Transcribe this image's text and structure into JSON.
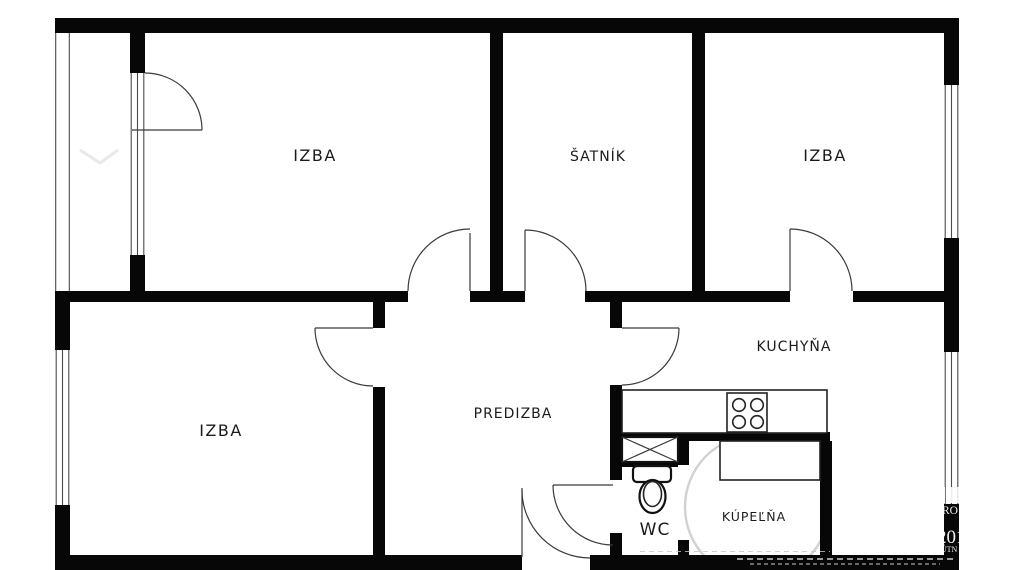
{
  "floorplan": {
    "rooms": [
      {
        "id": "izba-top-left",
        "label": "IZBA"
      },
      {
        "id": "satnik",
        "label": "ŠATNÍK"
      },
      {
        "id": "izba-top-right",
        "label": "IZBA"
      },
      {
        "id": "izba-bottom-left",
        "label": "IZBA"
      },
      {
        "id": "predizba",
        "label": "PREDIZBA"
      },
      {
        "id": "kuchyna",
        "label": "KUCHYŇA"
      },
      {
        "id": "wc",
        "label": "WC"
      },
      {
        "id": "kupelna",
        "label": "KÚPEĽŇA"
      }
    ],
    "fixtures": [
      "stove",
      "toilet",
      "bathtub",
      "installation-shaft",
      "kitchen-counter"
    ],
    "watermark": {
      "line1": "RO",
      "line2": "201",
      "line3": "ĽÚTN"
    },
    "colors": {
      "wall": "#070707",
      "background": "#ffffff",
      "thin_line": "#3a3a3a",
      "watermark_gray": "#c9c9c9"
    }
  }
}
